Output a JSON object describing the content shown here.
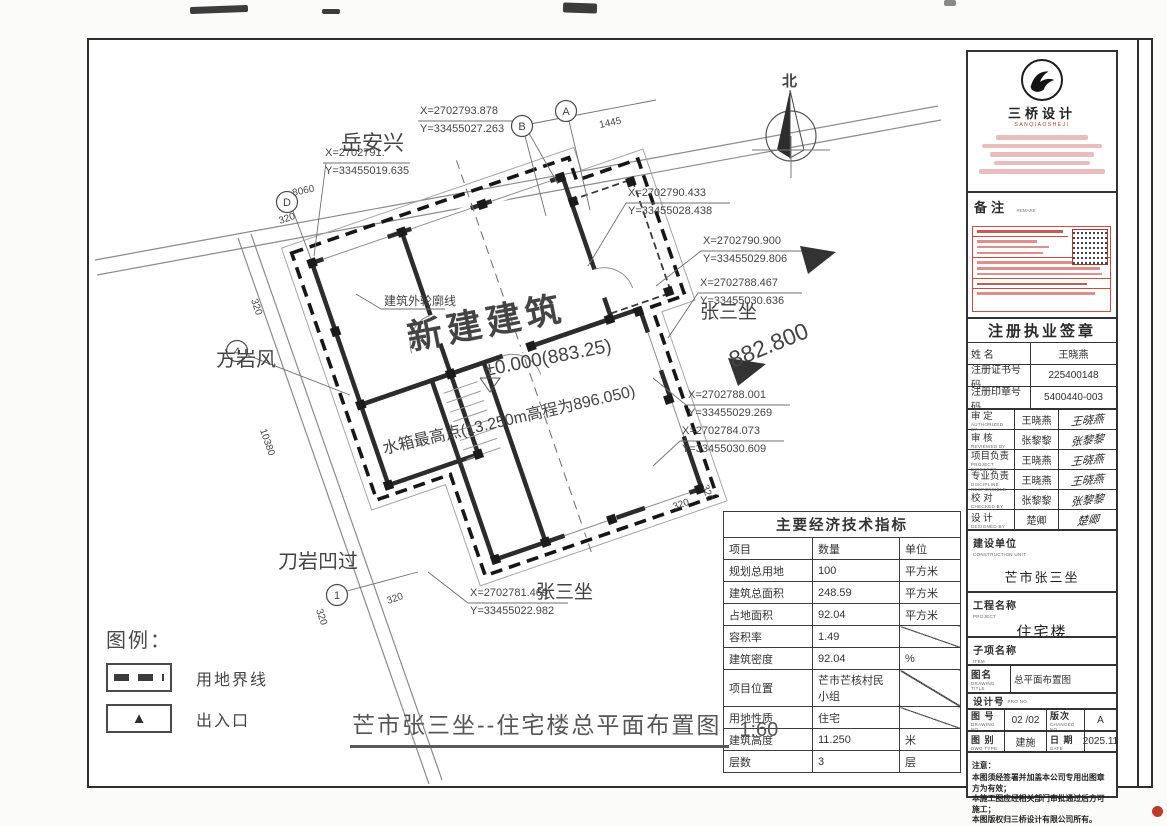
{
  "plan": {
    "labels": {
      "north": "北",
      "building": "新建建筑",
      "level": "±0.000(883.25)",
      "tank": "水箱最高点(13.250m高程为896.050)",
      "outline": "建筑外轮廓线",
      "elevation": "882.800"
    },
    "neighbors": {
      "top": "岳安兴",
      "left": "方岩风",
      "bottom_left": "刀岩凹过",
      "right": "张三坐",
      "bottom": "张三坐"
    },
    "coords": [
      {
        "x": "X=2702793.878",
        "y": "Y=33455027.263"
      },
      {
        "x": "X=2702791.",
        "y": "Y=33455019.635"
      },
      {
        "x": "X=2702790.433",
        "y": "Y=33455028.438"
      },
      {
        "x": "X=2702790.900",
        "y": "Y=33455029.806"
      },
      {
        "x": "X=2702788.467",
        "y": "Y=33455030.636"
      },
      {
        "x": "X=2702788.001",
        "y": "Y=33455029.269"
      },
      {
        "x": "X=2702784.073",
        "y": "Y=33455030.609"
      },
      {
        "x": "X=2702781.469",
        "y": "Y=33455022.982"
      }
    ],
    "bubbles": {
      "a": "A",
      "b": "B",
      "d": "D",
      "n4": "4",
      "n1": "1"
    },
    "dims": {
      "d8060": "8060",
      "d1445": "1445",
      "d320": "320",
      "d10380": "10380"
    }
  },
  "legend": {
    "title": "图例：",
    "boundary_label": "用地界线",
    "entrance_label": "出入口",
    "entrance_glyph": "▲"
  },
  "table": {
    "title": "主要经济技术指标",
    "headers": {
      "item": "项目",
      "qty": "数量",
      "unit": "单位"
    },
    "rows": [
      {
        "item": "规划总用地",
        "qty": "100",
        "unit": "平方米"
      },
      {
        "item": "建筑总面积",
        "qty": "248.59",
        "unit": "平方米"
      },
      {
        "item": "占地面积",
        "qty": "92.04",
        "unit": "平方米"
      },
      {
        "item": "容积率",
        "qty": "1.49",
        "unit": ""
      },
      {
        "item": "建筑密度",
        "qty": "92.04",
        "unit": "%"
      },
      {
        "item": "项目位置",
        "qty": "芒市芒核村民小组",
        "unit": ""
      },
      {
        "item": "用地性质",
        "qty": "住宅",
        "unit": ""
      },
      {
        "item": "建筑高度",
        "qty": "11.250",
        "unit": "米"
      },
      {
        "item": "层数",
        "qty": "3",
        "unit": "层"
      }
    ]
  },
  "footer": {
    "title": "芒市张三坐--住宅楼总平面布置图",
    "scale": "1:60"
  },
  "titleblock": {
    "logo": {
      "name": "三桥设计",
      "sub": "SANQIAOSHEJI"
    },
    "remark": {
      "label": "备注",
      "sub": "REMARK"
    },
    "seal": {
      "title": "注册执业签章",
      "rows": [
        {
          "label": "姓  名",
          "value": "王晓燕"
        },
        {
          "label": "注册证书号码",
          "value": "225400148"
        },
        {
          "label": "注册印章号码",
          "value": "5400440-003"
        }
      ]
    },
    "signoff": [
      {
        "label": "审  定",
        "en": "AUTHORIZED BY",
        "name": "王晓燕",
        "sig": "王晓燕"
      },
      {
        "label": "审  核",
        "en": "REVIEWED BY",
        "name": "张黎黎",
        "sig": "张黎黎"
      },
      {
        "label": "项目负责",
        "en": "PROJECT DIRECTOR",
        "name": "王晓燕",
        "sig": "王晓燕"
      },
      {
        "label": "专业负责",
        "en": "DISCIPLINE RESPONSIBLE",
        "name": "王晓燕",
        "sig": "王晓燕"
      },
      {
        "label": "校  对",
        "en": "CHECKED BY",
        "name": "张黎黎",
        "sig": "张黎黎"
      },
      {
        "label": "设  计",
        "en": "DESIGNED BY",
        "name": "楚卿",
        "sig": "楚卿"
      }
    ],
    "owner": {
      "label": "建设单位",
      "en": "CONSTRUCTION UNIT",
      "value": "芒市张三坐"
    },
    "project": {
      "label": "工程名称",
      "en": "PROJECT",
      "value": "住宅楼"
    },
    "subitem": {
      "label": "子项名称",
      "en": "ITEM",
      "value": ""
    },
    "drawing": {
      "label": "图名",
      "en": "DRAWING TITLE",
      "value": "总平面布置图"
    },
    "design_no": {
      "label": "设计号",
      "en": "PRO NO.",
      "value": ""
    },
    "row_no": {
      "label": "图  号",
      "en": "DRAWING NO.",
      "value": "02 /02",
      "rev_label": "版次",
      "rev_en": "CHANGED NO.",
      "rev": "A"
    },
    "row_type": {
      "label": "图  别",
      "en": "DWG TYPE",
      "value": "建施",
      "date_label": "日  期",
      "date_en": "DATE",
      "date": "2025.11"
    },
    "notes": {
      "label": "注意：",
      "lines": [
        "本图须经签署并加盖本公司专用出图章方为有效；",
        "本施工图应经相关部门审批通过后方可施工；",
        "本图版权归三桥设计有限公司所有。"
      ]
    }
  },
  "watermark": {
    "text": "利用 pdfFactory Pro 测试版本创建的PDF文档 ",
    "url": "www.pdffactory.com",
    "badge": "●"
  }
}
